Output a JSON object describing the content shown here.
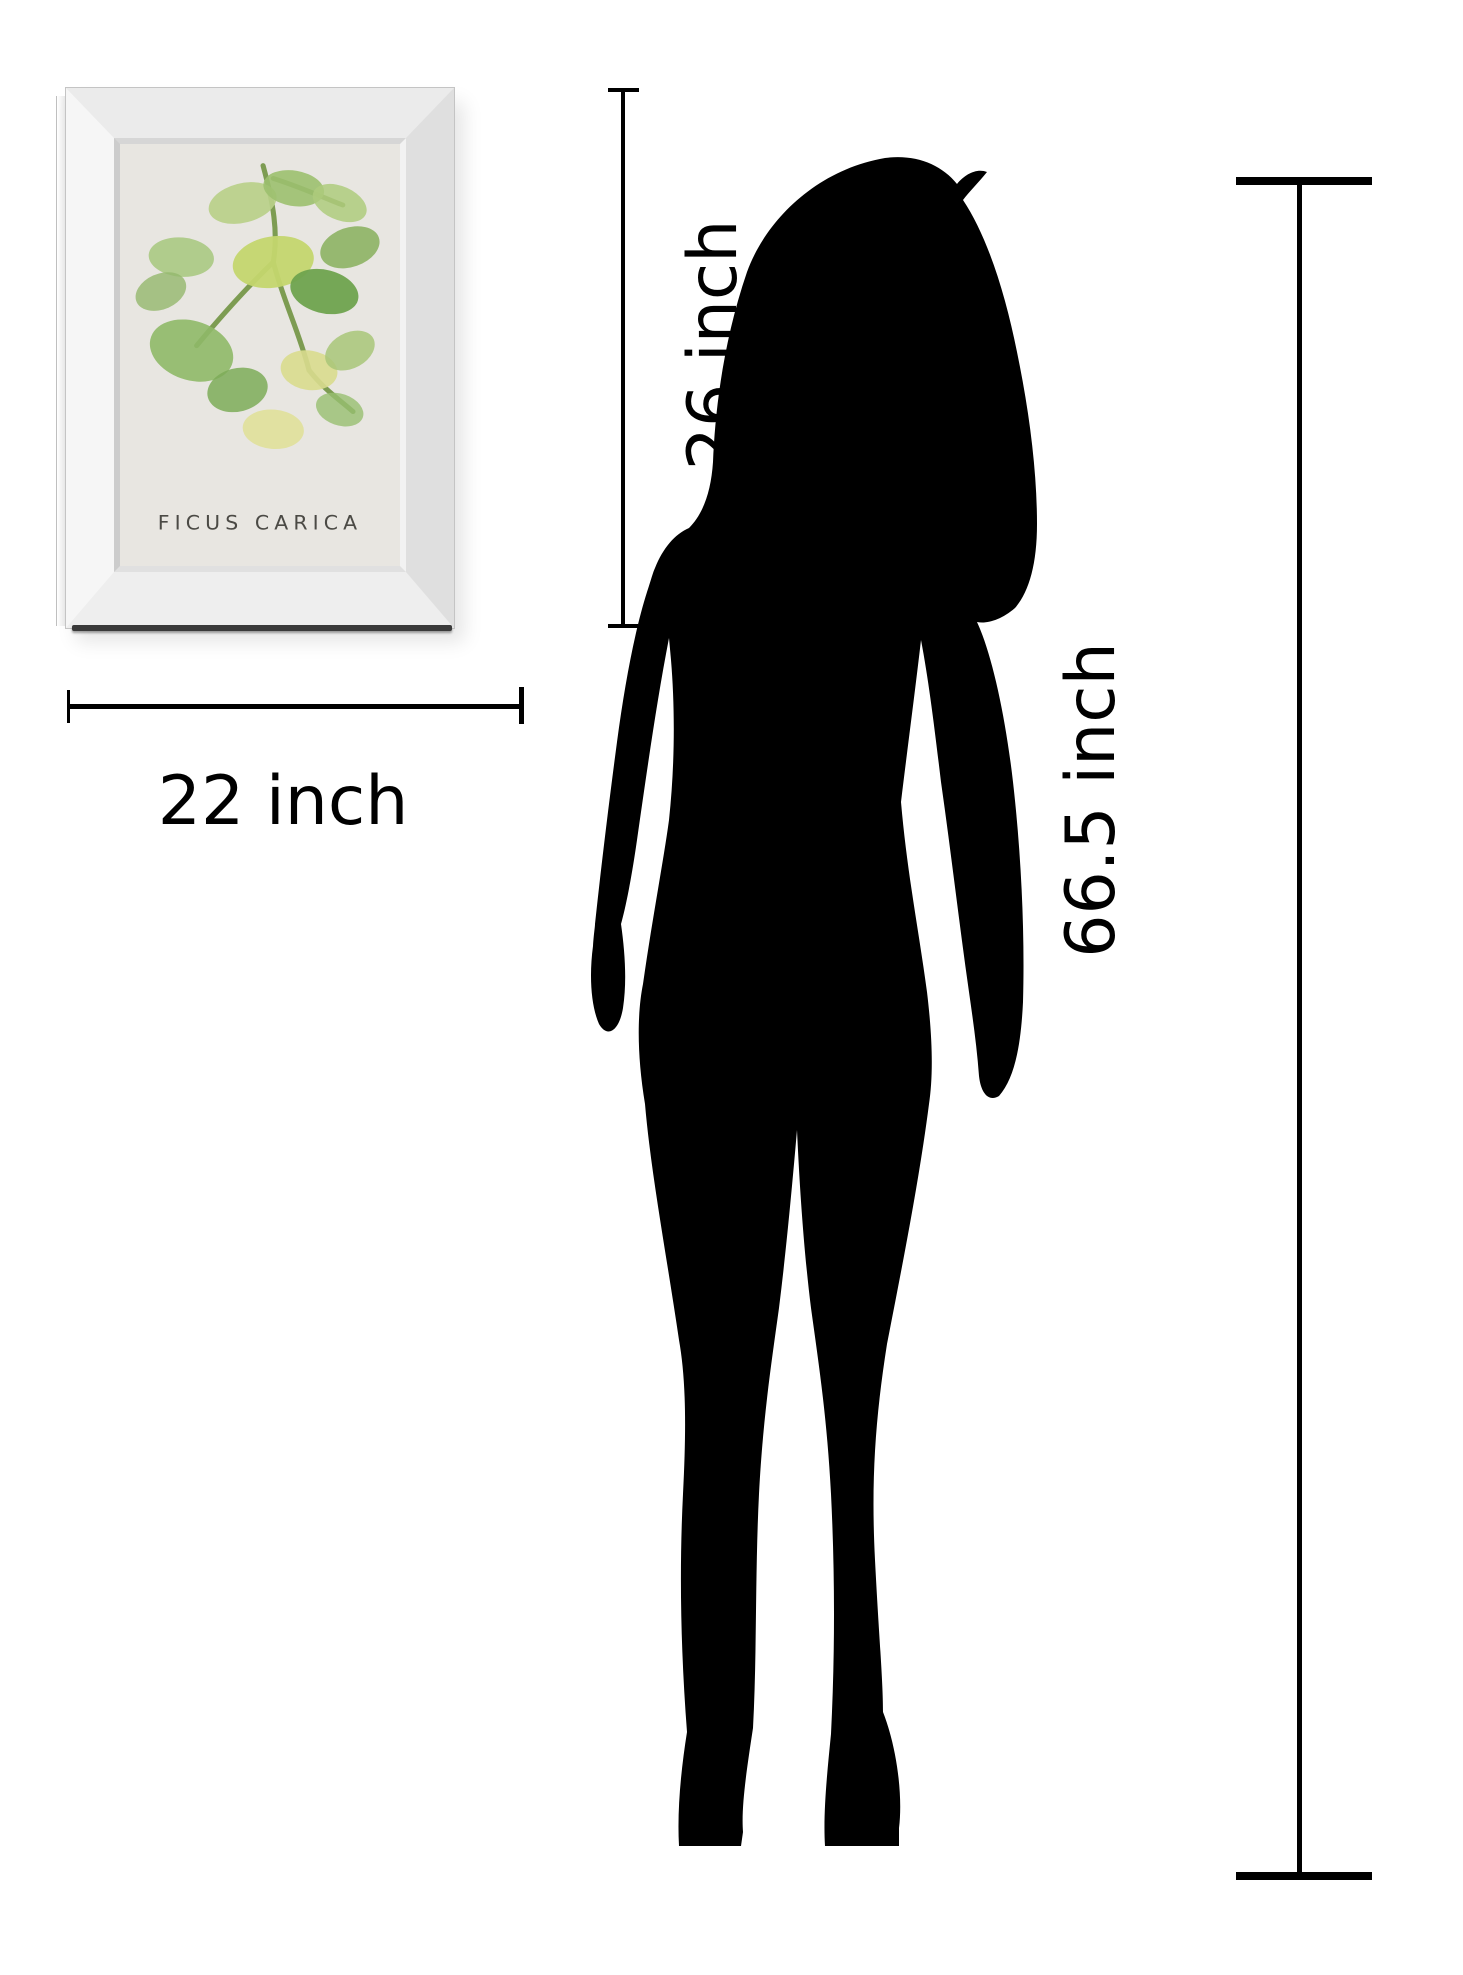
{
  "page": {
    "background_color": "#ffffff",
    "type": "product-size-comparison-diagram"
  },
  "artwork": {
    "caption": "FICUS CARICA",
    "frame_style": "mirrored beveled frame",
    "art_background_color": "#e8e6e1",
    "stem_color": "#7d9c52",
    "caption_color": "#4b4a45",
    "leaf_palette": [
      "#b8d089",
      "#9cc06f",
      "#aecb7d",
      "#8db364",
      "#a6c77c",
      "#93b86d",
      "#c4d66e",
      "#6fa34e",
      "#8fb968",
      "#7dab58",
      "#d9dc8e",
      "#a8c578",
      "#e0e09a",
      "#97bf70"
    ]
  },
  "dimensions": {
    "width": {
      "label": "22 inch",
      "value": 22,
      "unit": "inch",
      "orientation": "horizontal"
    },
    "height": {
      "label": "26 inch",
      "value": 26,
      "unit": "inch",
      "orientation": "vertical"
    },
    "person_height": {
      "label": "66.5 inch",
      "value": 66.5,
      "unit": "inch",
      "orientation": "vertical"
    }
  },
  "silhouette": {
    "description": "black silhouette of standing woman in heels",
    "color": "#000000"
  },
  "line_color": "#000000",
  "text_color": "#000000"
}
